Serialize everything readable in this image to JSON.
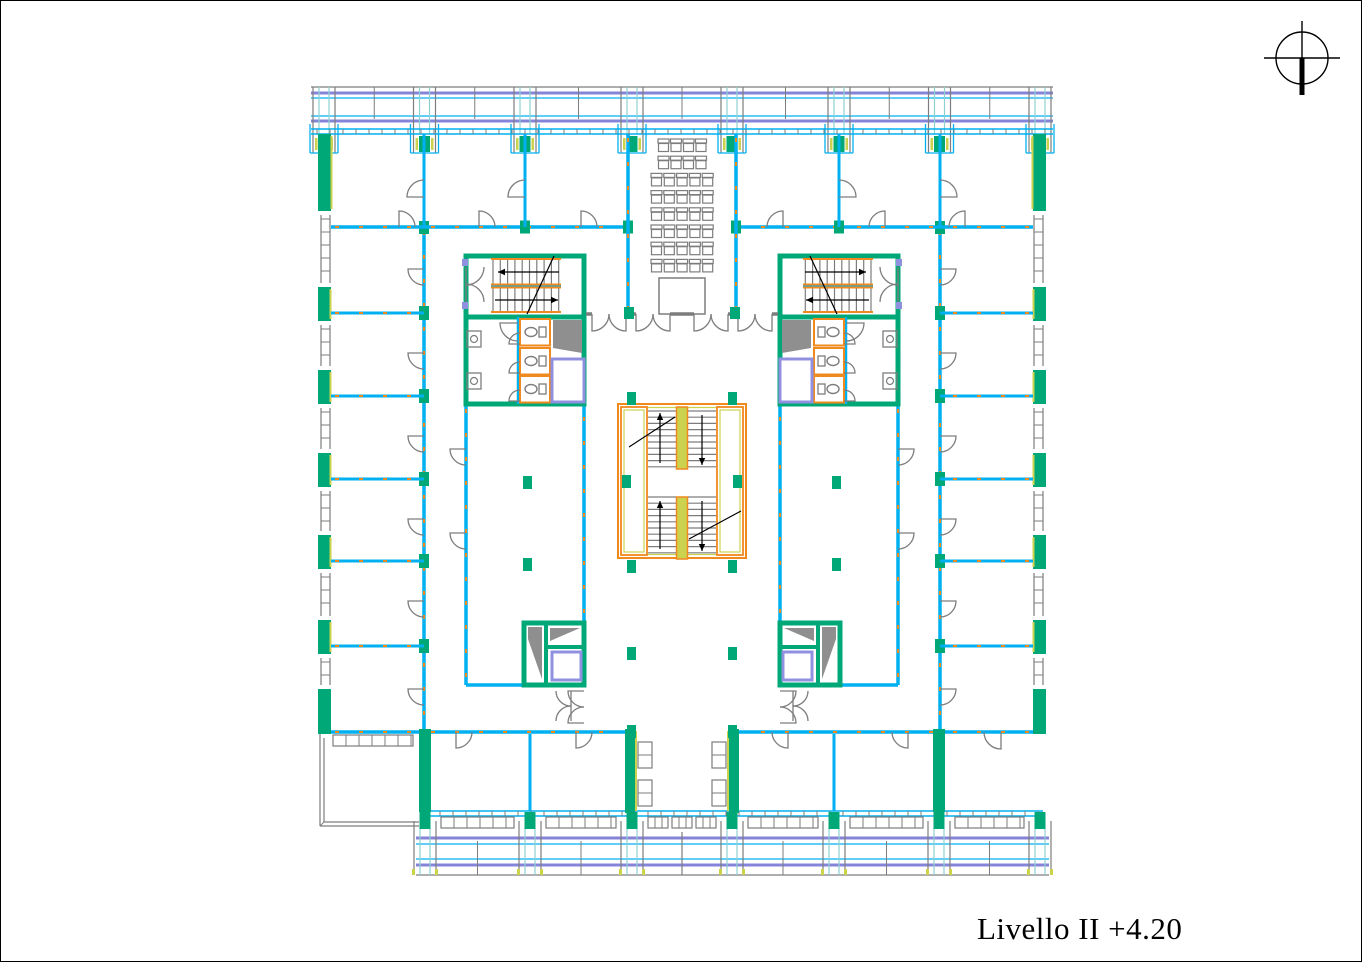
{
  "title_block": {
    "label": "Livello II +4.20",
    "level": "II",
    "elevation": "+4.20"
  },
  "north_symbol": {
    "icon": "north-orientation-icon"
  },
  "drawing": {
    "type": "architectural-floor-plan",
    "features": [
      "perimeter-office-rooms",
      "central-double-staircase",
      "two-stair-cores-with-wc",
      "elevators",
      "auditorium-seating-8-rows",
      "balcony-facade-bands",
      "south-west-terrace",
      "central-entrance-vestibule"
    ]
  },
  "palette": {
    "wall_green": "#00a878",
    "partition_cyan": "#00b0f0",
    "railing_purple": "#8484d8",
    "stair_yellow": "#ccd24e",
    "stair_orange": "#f0891e",
    "fixture_gray": "#7d7d7d",
    "glass_teal": "#8ed1d1",
    "hatch_gray": "#8f8f8f",
    "elevator_purple": "#9090e0",
    "line_black": "#000000",
    "paper_white": "#ffffff"
  }
}
